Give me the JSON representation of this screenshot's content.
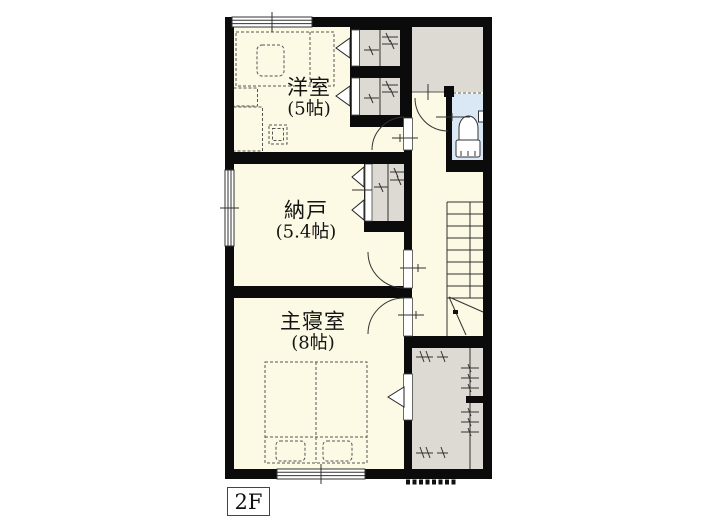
{
  "floor": {
    "label": "2F"
  },
  "rooms": [
    {
      "id": "western-room",
      "name": "洋室",
      "size": "(5帖)"
    },
    {
      "id": "storage-room",
      "name": "納戸",
      "size": "(5.4帖)"
    },
    {
      "id": "master-bedroom",
      "name": "主寝室",
      "size": "(8帖)"
    }
  ],
  "colors": {
    "page-bg": "#ffffff",
    "wall": "#0b0b0b",
    "room-fill": "#fcfae4",
    "closet-fill": "#dddad3",
    "toilet-fill": "#d9e8f4",
    "line": "#333333"
  }
}
